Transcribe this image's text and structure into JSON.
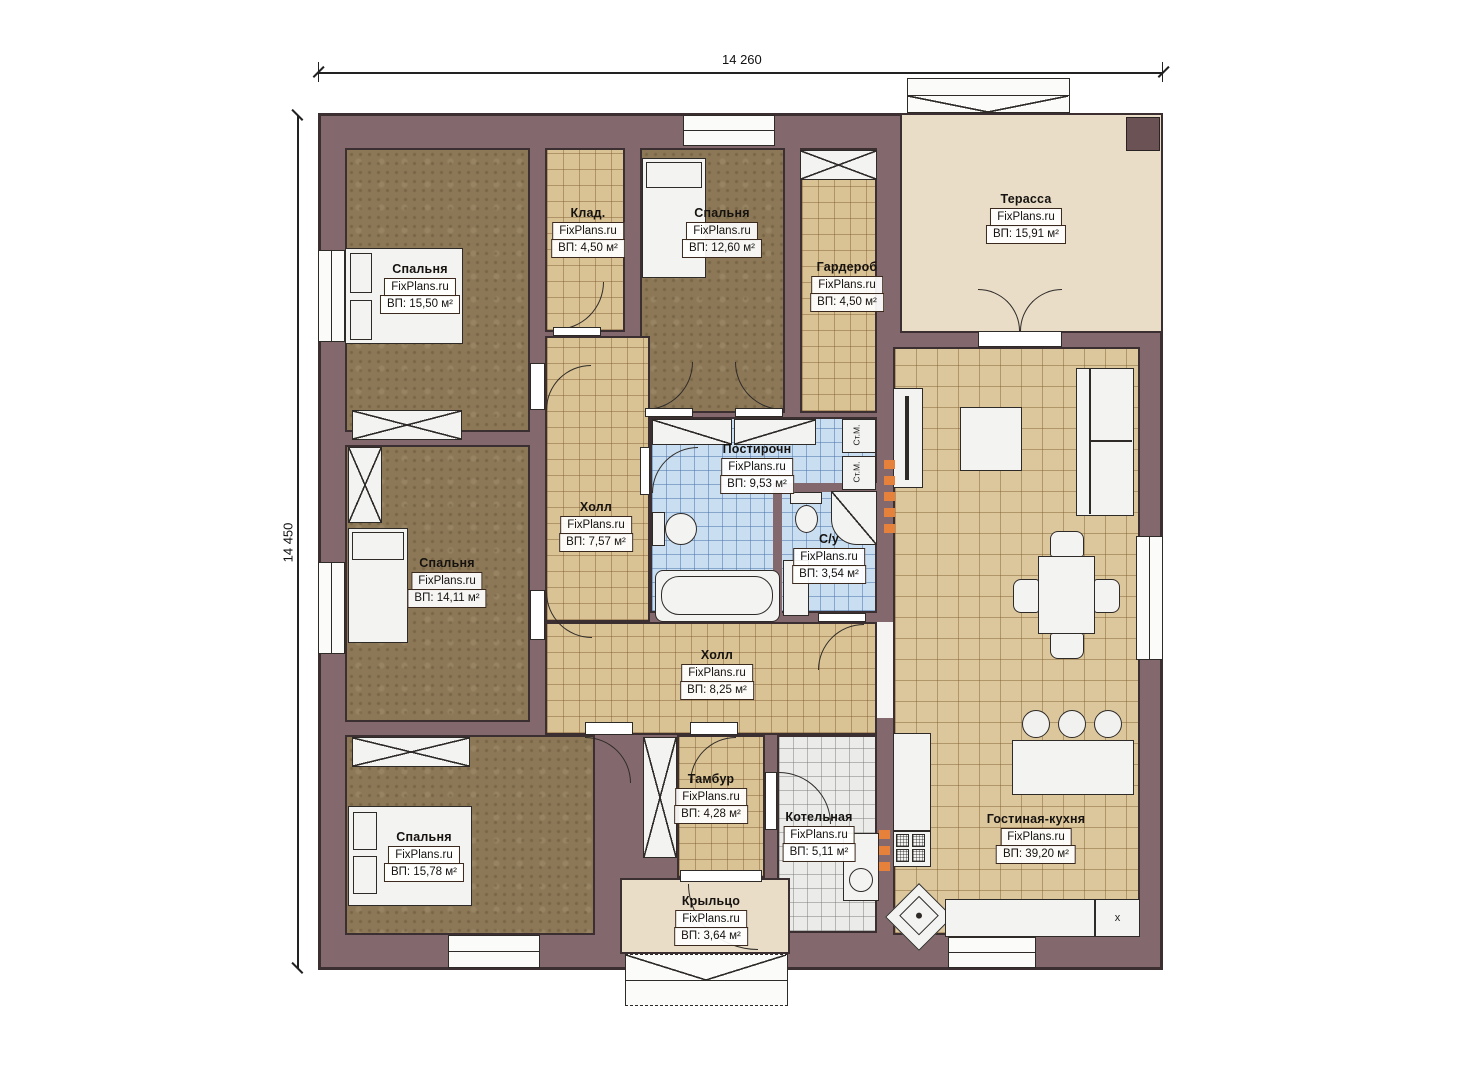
{
  "branding": {
    "watermark": "FixPlans.ru"
  },
  "dimensions": {
    "width_label": "14 260",
    "height_label": "14 450"
  },
  "rooms": [
    {
      "id": "bedroom-master",
      "name": "Спальня",
      "area": "ВП: 15,50 м²"
    },
    {
      "id": "klad",
      "name": "Клад.",
      "area": "ВП: 4,50 м²"
    },
    {
      "id": "bedroom-2",
      "name": "Спальня",
      "area": "ВП: 12,60 м²"
    },
    {
      "id": "garderob",
      "name": "Гардероб",
      "area": "ВП: 4,50 м²"
    },
    {
      "id": "terrace",
      "name": "Терасса",
      "area": "ВП: 15,91 м²"
    },
    {
      "id": "laundry",
      "name": "Постирочн",
      "area": "ВП: 9,53 м²"
    },
    {
      "id": "hall-1",
      "name": "Холл",
      "area": "ВП: 7,57 м²"
    },
    {
      "id": "bathroom",
      "name": "С/у",
      "area": "ВП: 3,54 м²"
    },
    {
      "id": "bedroom-3",
      "name": "Спальня",
      "area": "ВП: 14,11 м²"
    },
    {
      "id": "hall-2",
      "name": "Холл",
      "area": "ВП: 8,25 м²"
    },
    {
      "id": "bedroom-4",
      "name": "Спальня",
      "area": "ВП: 15,78 м²"
    },
    {
      "id": "tambur",
      "name": "Тамбур",
      "area": "ВП: 4,28 м²"
    },
    {
      "id": "kotelnaya",
      "name": "Котельная",
      "area": "ВП: 5,11 м²"
    },
    {
      "id": "living-kitchen",
      "name": "Гостиная-кухня",
      "area": "ВП: 39,20 м²"
    },
    {
      "id": "porch",
      "name": "Крыльцо",
      "area": "ВП: 3,64 м²"
    }
  ],
  "fixtures": {
    "washing_machine_label": "Ст.М.",
    "fridge_label": "x"
  },
  "colors": {
    "wall": "#83696d",
    "line": "#3c2f31",
    "accent": "#e5813a",
    "floor_brown": "#8c7857",
    "tile_tan": "#d9c294",
    "tile_blue": "#c9def1",
    "tile_gray": "#ebebea",
    "terrace": "#e9ddc8"
  }
}
